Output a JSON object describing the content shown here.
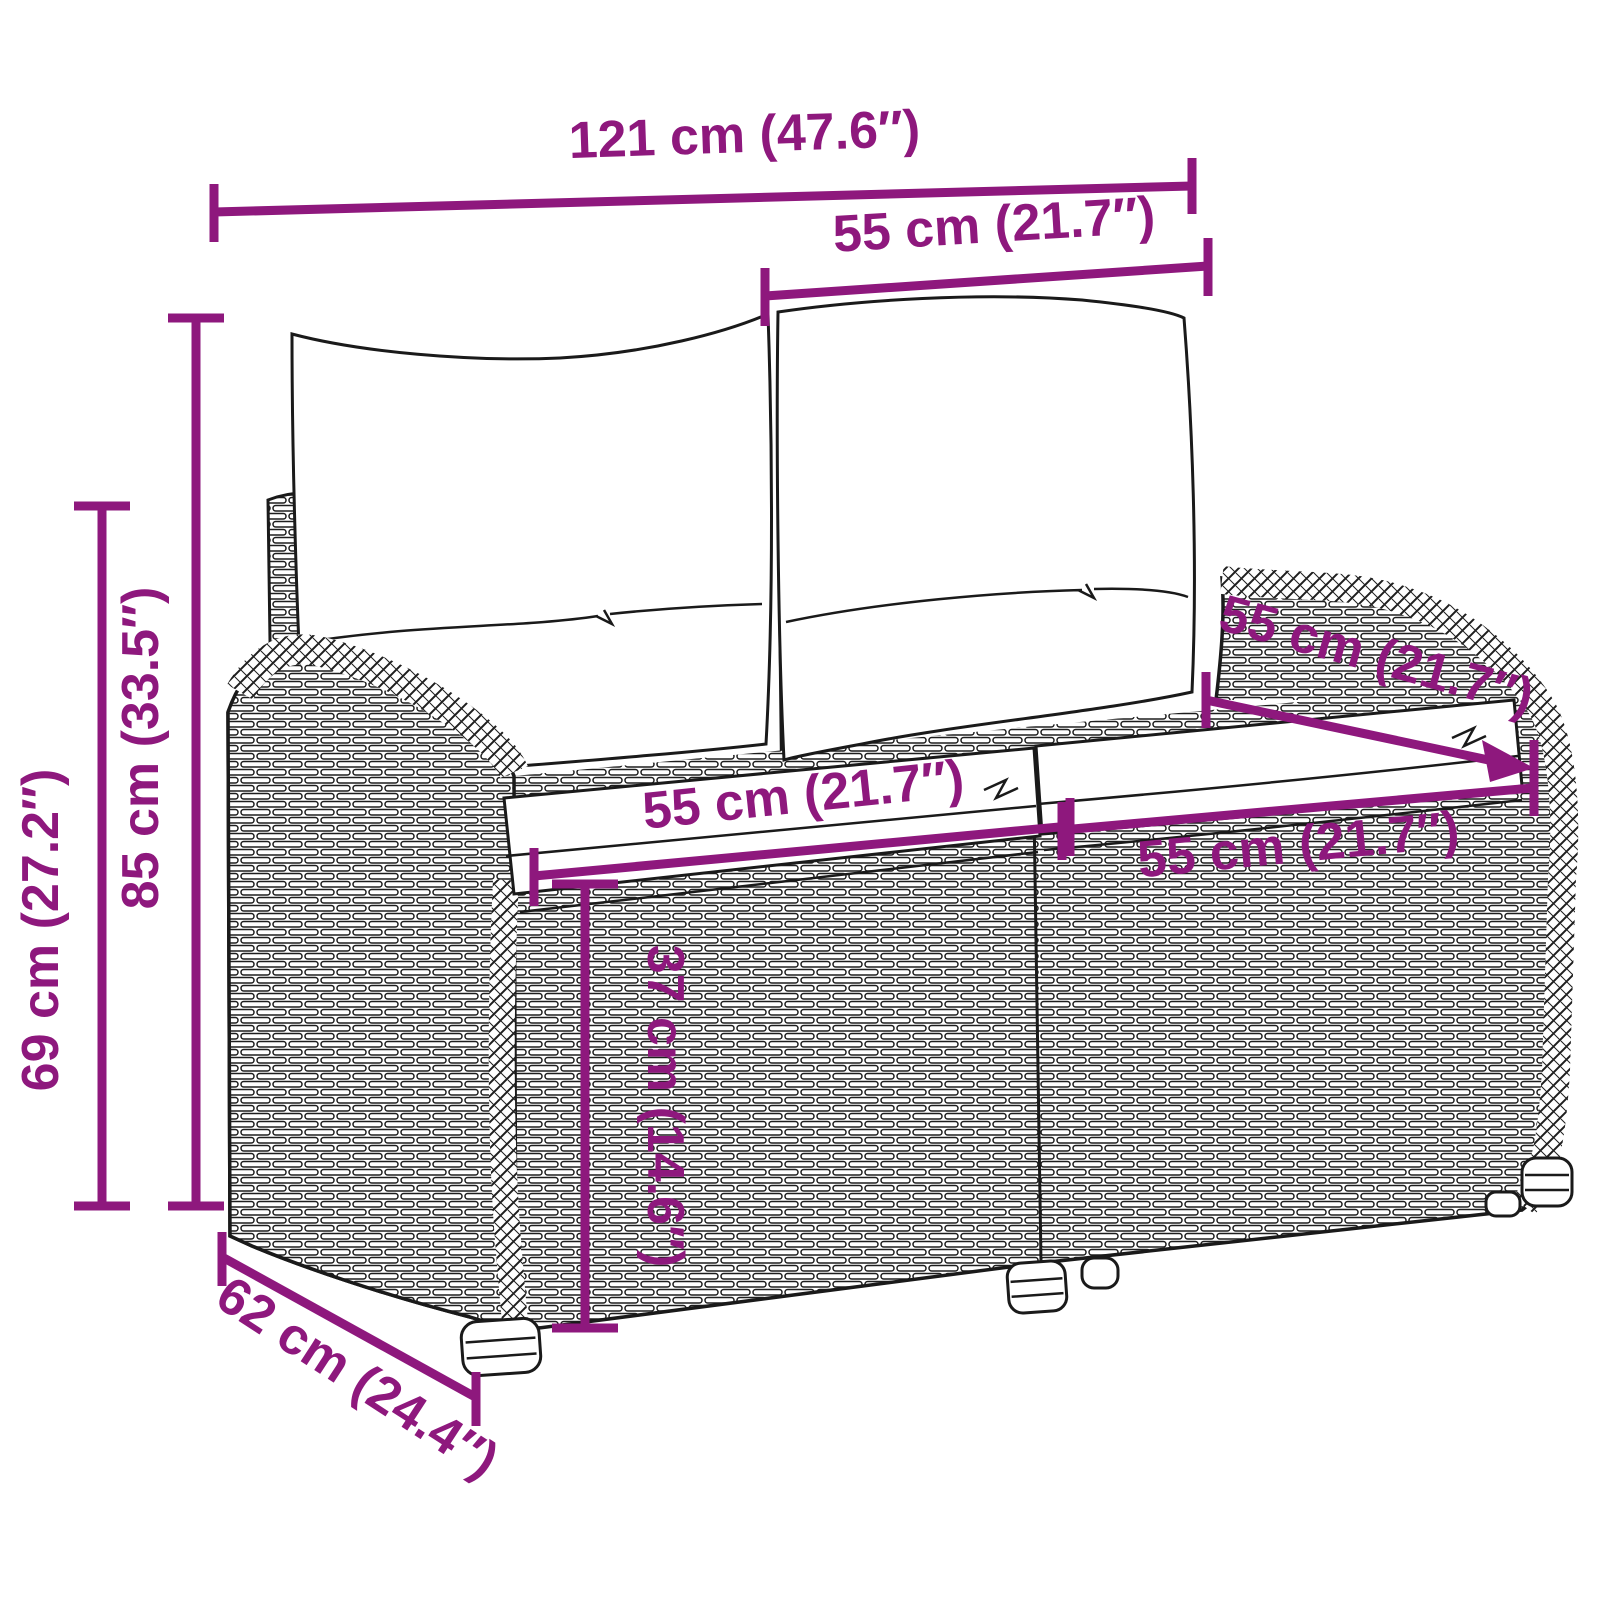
{
  "diagram": {
    "type": "product-dimension-diagram",
    "subject": "rattan-garden-bench-2-seater-with-cushions",
    "accent_color": "#8E187D",
    "line_color": "#1a1a1a",
    "background": "#ffffff",
    "units": [
      "cm",
      "inch"
    ],
    "annotations": {
      "total_width": {
        "label": "121 cm (47.6″)",
        "cm": 121,
        "inch": 47.6
      },
      "back_cushion_width": {
        "label": "55 cm (21.7″)",
        "cm": 55,
        "inch": 21.7
      },
      "total_height": {
        "label": "85 cm (33.5″)",
        "cm": 85,
        "inch": 33.5
      },
      "arm_height": {
        "label": "69 cm (27.2″)",
        "cm": 69,
        "inch": 27.2
      },
      "seat_width_left": {
        "label": "55 cm (21.7″)",
        "cm": 55,
        "inch": 21.7
      },
      "seat_width_right": {
        "label": "55 cm (21.7″)",
        "cm": 55,
        "inch": 21.7
      },
      "seat_depth": {
        "label": "55 cm (21.7″)",
        "cm": 55,
        "inch": 21.7
      },
      "seat_height": {
        "label": "37 cm (14.6″)",
        "cm": 37,
        "inch": 14.6
      },
      "total_depth": {
        "label": "62 cm (24.4″)",
        "cm": 62,
        "inch": 24.4
      }
    }
  }
}
